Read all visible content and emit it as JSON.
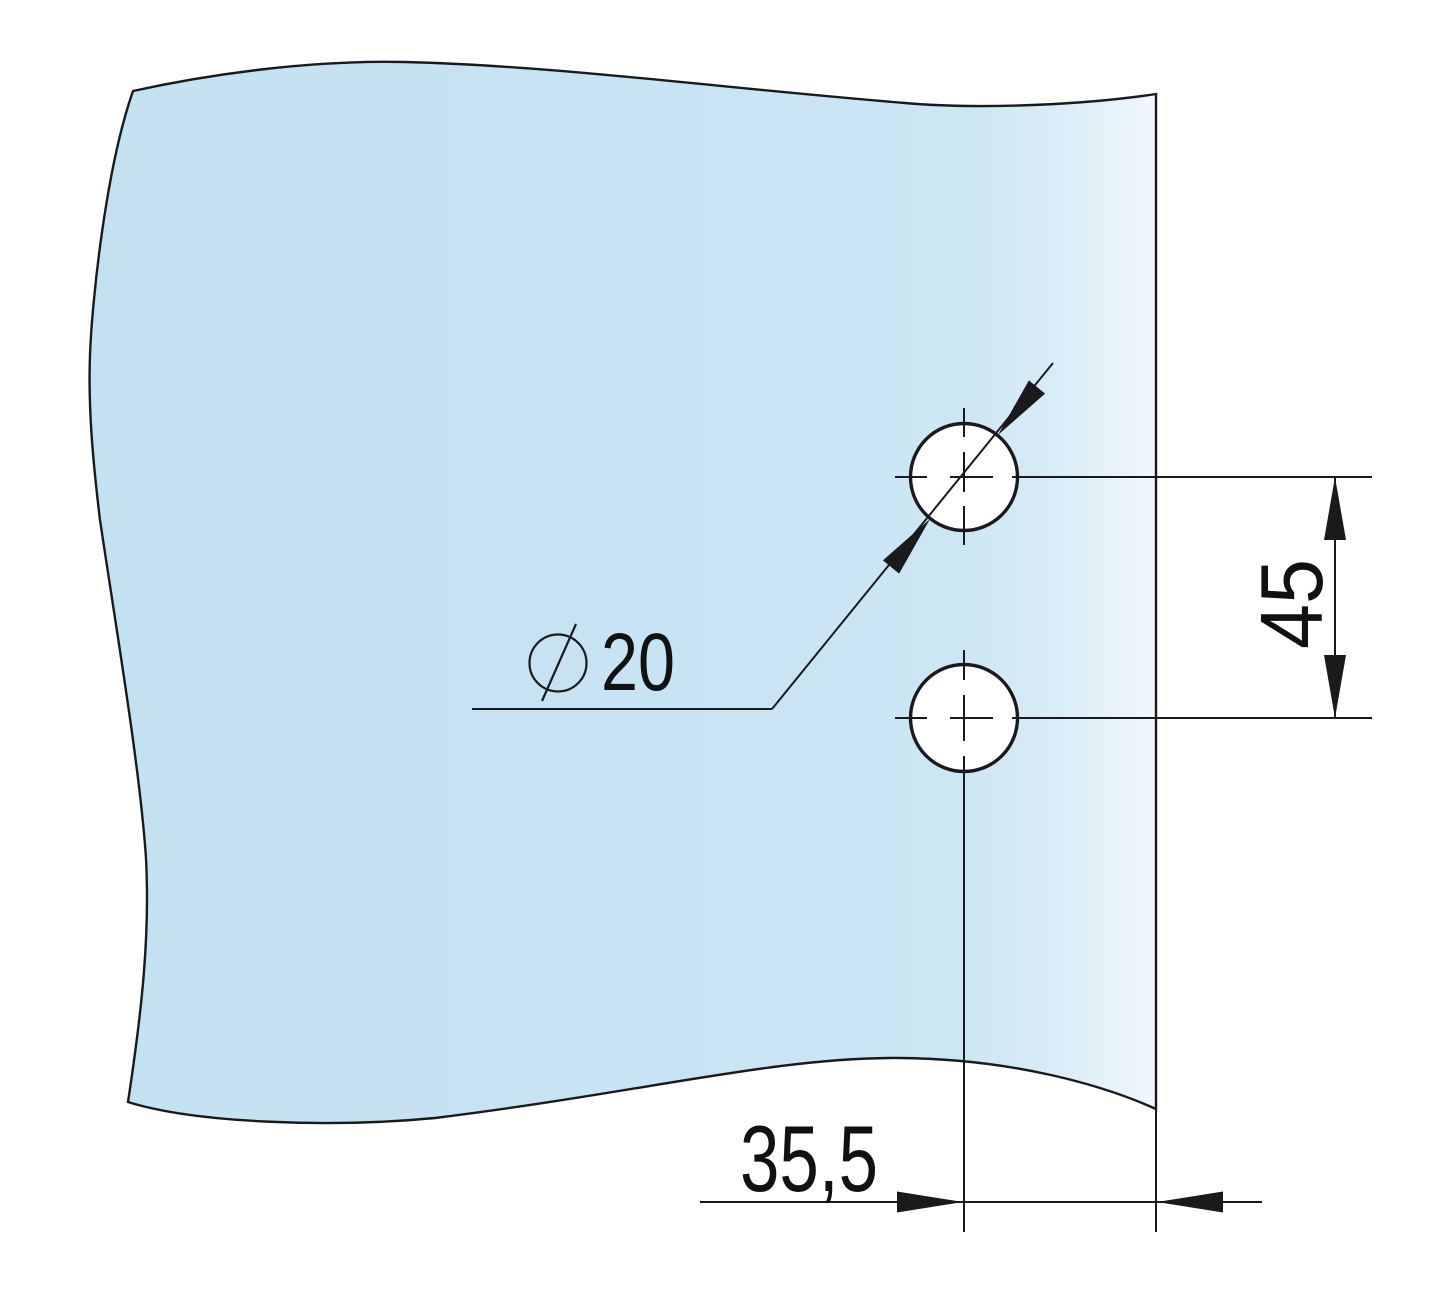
{
  "drawing": {
    "diameter_annotation": {
      "symbol": "⌀",
      "value": "20"
    },
    "vertical_dimension": "45",
    "horizontal_dimension": "35,5"
  },
  "colors": {
    "background": "#ffffff",
    "line": "#1a1a1c",
    "text": "#111111",
    "hole_fill": "#ffffff",
    "glass_0": "#c4e1f2",
    "glass_1": "#c8e3f3",
    "glass_2": "#cde6f4",
    "glass_3": "#d8ecf7",
    "glass_4": "#e8f3fa",
    "glass_5": "#f0f8fd"
  }
}
